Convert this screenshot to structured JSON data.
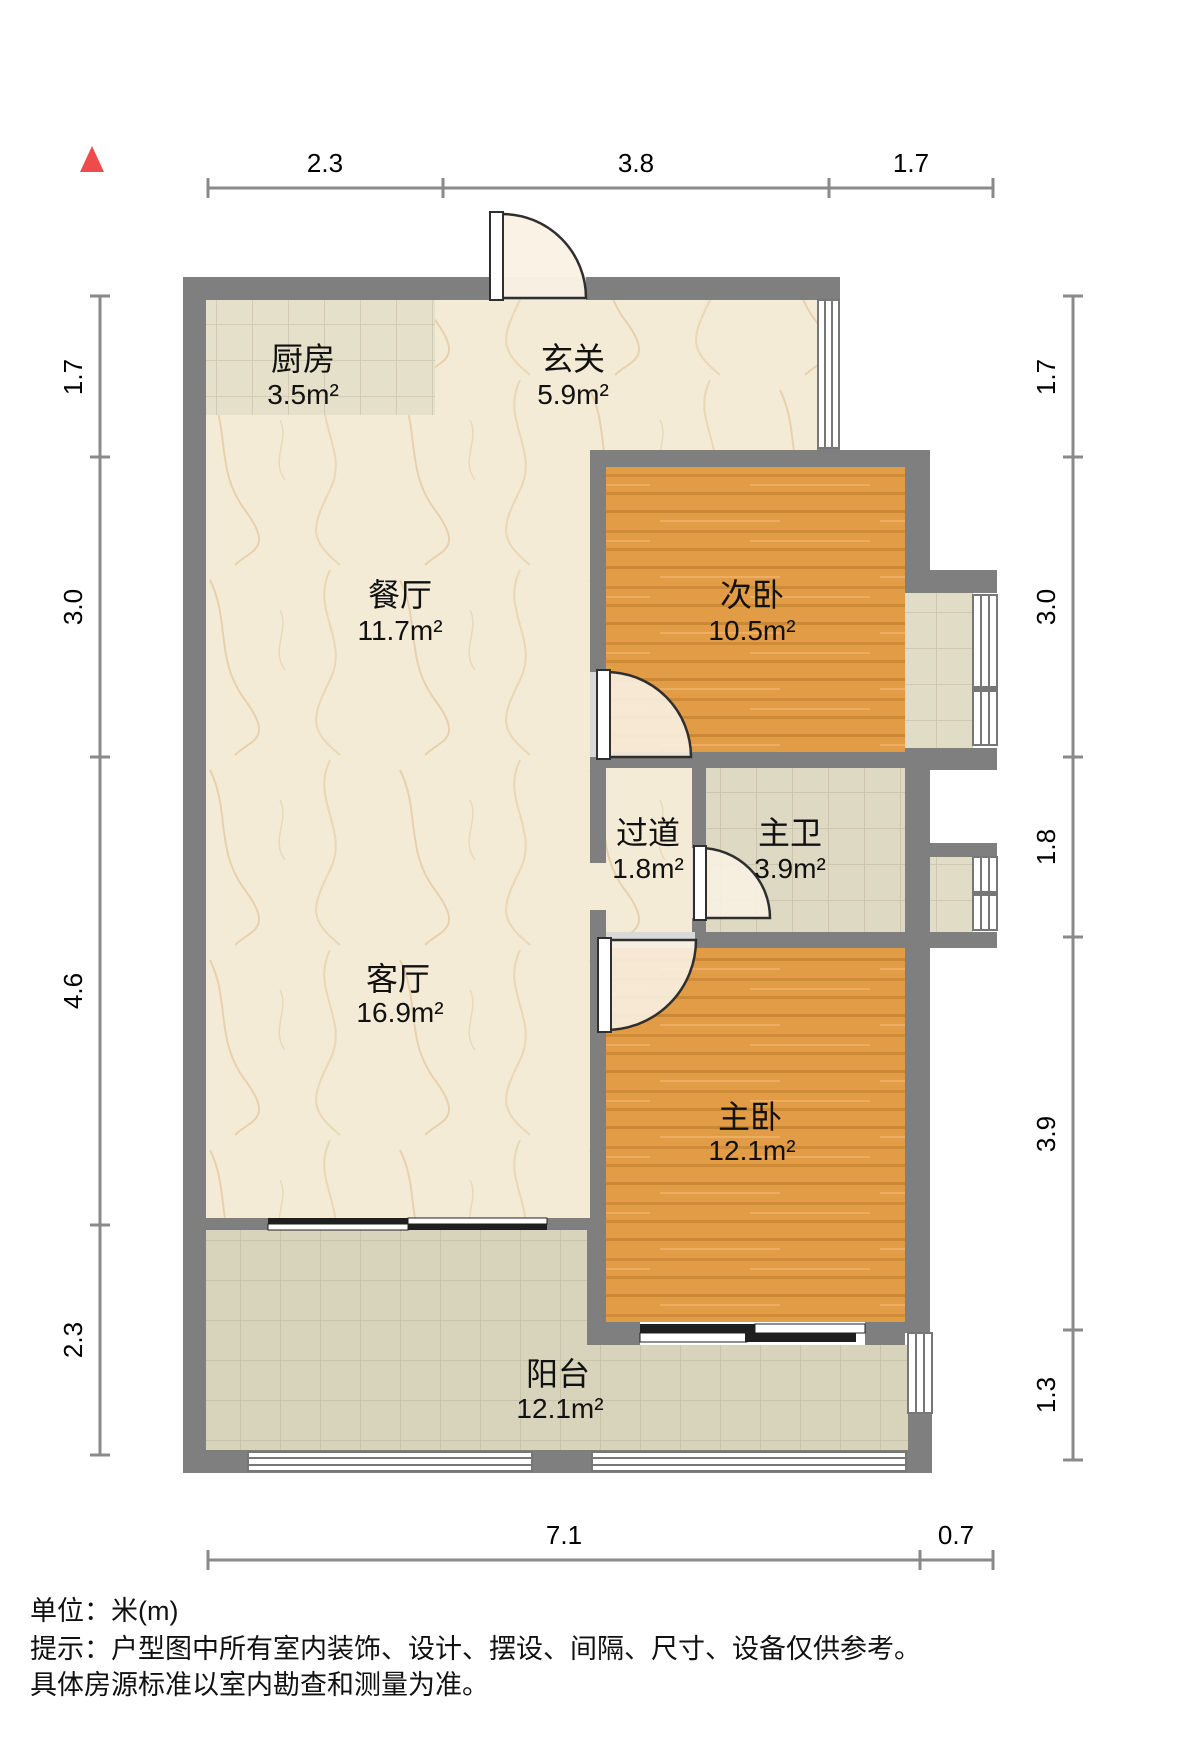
{
  "rooms": [
    {
      "id": "kitchen",
      "name": "厨房",
      "area": "3.5m²"
    },
    {
      "id": "entry",
      "name": "玄关",
      "area": "5.9m²"
    },
    {
      "id": "dining",
      "name": "餐厅",
      "area": "11.7m²"
    },
    {
      "id": "bedroom2",
      "name": "次卧",
      "area": "10.5m²"
    },
    {
      "id": "hallway",
      "name": "过道",
      "area": "1.8m²"
    },
    {
      "id": "master-bath",
      "name": "主卫",
      "area": "3.9m²"
    },
    {
      "id": "living",
      "name": "客厅",
      "area": "16.9m²"
    },
    {
      "id": "master-bedroom",
      "name": "主卧",
      "area": "12.1m²"
    },
    {
      "id": "balcony",
      "name": "阳台",
      "area": "12.1m²"
    }
  ],
  "dimensions": {
    "unit": "m",
    "top": [
      "2.3",
      "3.8",
      "1.7"
    ],
    "bottom": [
      "7.1",
      "0.7"
    ],
    "left": [
      "1.7",
      "3.0",
      "4.6",
      "2.3"
    ],
    "right": [
      "1.7",
      "3.0",
      "1.8",
      "3.9",
      "1.3"
    ]
  },
  "footer": {
    "unit_label": "单位：米(m)",
    "tip_line1": "提示：户型图中所有室内装饰、设计、摆设、间隔、尺寸、设备仅供参考。",
    "tip_line2": "具体房源标准以室内勘查和测量为准。"
  },
  "icons": {
    "north_arrow": "north-arrow-icon"
  },
  "colors": {
    "wall_gray": "#7f7f7f",
    "floor_marble_cream": "#f4ebd7",
    "floor_wood_orange": "#e29c45",
    "floor_tile_kitchen": "#e5e0c9",
    "floor_tile_bath": "#ded9c2",
    "floor_tile_platform": "#e1dcc5",
    "floor_tile_balcony": "#d8d3bb",
    "door_swing_fill": "#f8f1e2",
    "door_threshold": "#d9d9d9",
    "window_white": "#ffffff",
    "frame_line": "#777777",
    "dim_line": "#8a8a8a",
    "north_arrow_red": "#ef4b4b",
    "text_black": "#111111"
  }
}
